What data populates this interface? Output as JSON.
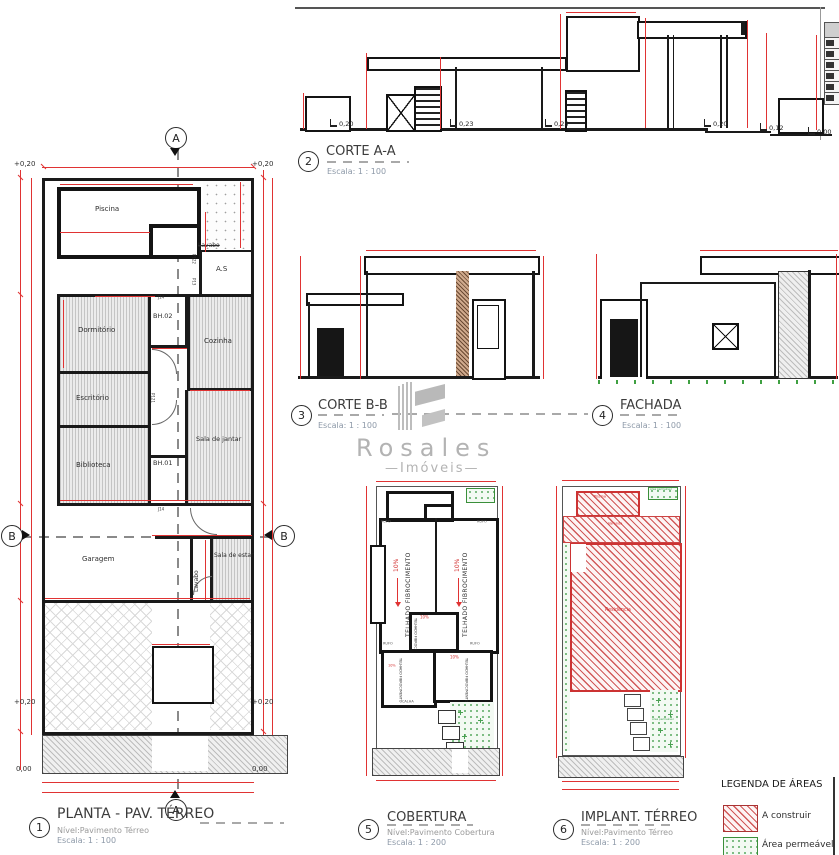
{
  "viewports": {
    "planta": {
      "num": "1",
      "title": "PLANTA - PAV. TÉRREO",
      "level": "Nível:Pavimento Térreo",
      "scale": "Escala: 1 : 100"
    },
    "corte_a": {
      "num": "2",
      "title": "CORTE A-A",
      "scale": "Escala: 1 : 100"
    },
    "corte_b": {
      "num": "3",
      "title": "CORTE B-B",
      "scale": "Escala: 1 : 100"
    },
    "fachada": {
      "num": "4",
      "title": "FACHADA",
      "scale": "Escala: 1 : 100"
    },
    "cobertura": {
      "num": "5",
      "title": "COBERTURA",
      "level": "Nível:Pavimento Cobertura",
      "scale": "Escala: 1 : 200"
    },
    "implantacao": {
      "num": "6",
      "title": "IMPLANT. TÉRREO",
      "level": "Nível:Pavimento Térreo",
      "scale": "Escala: 1 : 200"
    }
  },
  "plan": {
    "rooms": {
      "piscina": "Piscina",
      "area_servico": "A.S",
      "lavabo_servico": "Lavabo",
      "dormitorio": "Dormitório",
      "bh02": "BH.02",
      "cozinha": "Cozinha",
      "escritorio": "Escritório",
      "sala_jantar": "Sala de jantar",
      "biblioteca": "Biblioteca",
      "bh01": "BH.01",
      "garagem": "Garagem",
      "lavabo": "Lavabo",
      "sala_estar": "Sala de estar"
    },
    "levels": {
      "plus020": "+0,20",
      "zero": "0,00"
    },
    "tags": {
      "p122": "P122",
      "p13": "P13",
      "p121": "P121",
      "j14": "J14"
    },
    "markers": {
      "a": "A",
      "b": "B"
    }
  },
  "corte_a_levels": [
    "0,20",
    "0,23",
    "0,25",
    "0,20",
    "0,12",
    "0,00"
  ],
  "cobertura": {
    "roof": "TELHADO FIBROCIMENTO",
    "slope": "10%",
    "rufo": "RUFO",
    "calha": "CALHA"
  },
  "implantacao": {
    "piscina": "Piscina",
    "varanda": "Varanda",
    "residencia": "Residência",
    "permeavel": "Área permeável"
  },
  "legend": {
    "title": "LEGENDA DE ÁREAS",
    "construir": "A construir",
    "permeavel": "Área permeável"
  },
  "watermark": {
    "name": "Rosales",
    "tagline": "—Imóveis—"
  },
  "colors": {
    "dimension_red": "#e03333",
    "ink_black": "#1a1a1a",
    "permeable_green": "#3f9e4d",
    "watermark_gray": "#b3b3b3"
  }
}
